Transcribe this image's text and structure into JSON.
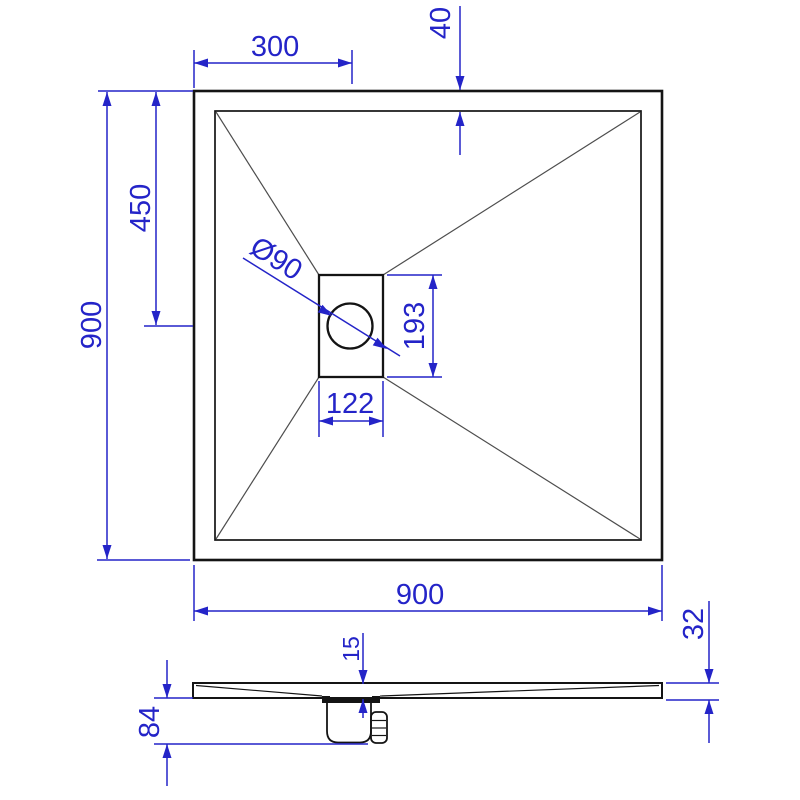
{
  "drawing_title": "Square shower tray dimension drawing 900 x 900",
  "colors": {
    "dimension_blue": "#2424c8",
    "outline_black": "#141414",
    "diagonal_gray": "#4d4d4d",
    "background": "#ffffff"
  },
  "plan_view": {
    "dims": {
      "drain_center_from_left": "300",
      "rim_width": "40",
      "drain_center_from_top": "450",
      "overall_height": "900",
      "drain_hole_diameter": "Ø90",
      "drain_recess_length": "193",
      "drain_recess_width": "122",
      "overall_width": "900"
    }
  },
  "side_view": {
    "dims": {
      "edge_thickness": "32",
      "drain_recess_depth": "15",
      "trap_depth_below": "84"
    }
  }
}
